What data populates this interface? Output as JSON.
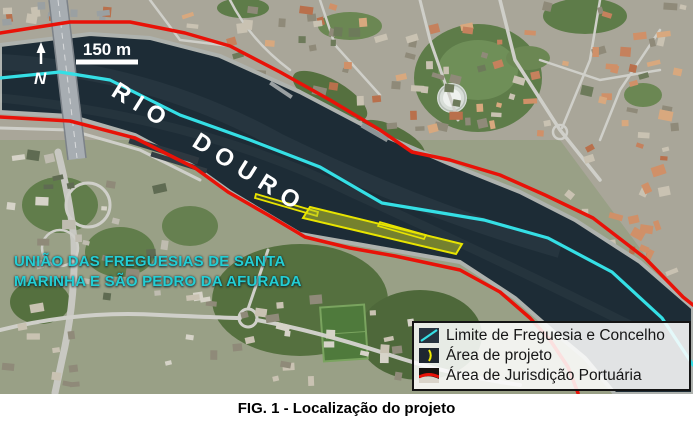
{
  "figure": {
    "caption": "FIG. 1 - Localização do projeto"
  },
  "map": {
    "river_label": "RIO DOURO",
    "north_label": "N",
    "scale_label": "150 m",
    "area_label": {
      "line1": "UNIÃO DAS FREGUESIAS DE SANTA",
      "line2": "MARINHA E SÃO PEDRO DA AFURADA"
    },
    "legend": {
      "items": [
        {
          "label": "Limite de Freguesia e Concelho",
          "symbol": "cyan-boundary-line",
          "color": "#35dfe5"
        },
        {
          "label": "Área de projeto",
          "symbol": "yellow-project-area",
          "color": "#e8e400"
        },
        {
          "label": "Área de Jurisdição Portuária",
          "symbol": "red-jurisdiction-line",
          "color": "#e81208"
        }
      ]
    },
    "colors": {
      "river": "#1d2c36",
      "boundary_line": "#35dfe5",
      "project_area": "#e8e400",
      "jurisdiction_line": "#e81208",
      "area_label_text": "#23ced4"
    }
  }
}
